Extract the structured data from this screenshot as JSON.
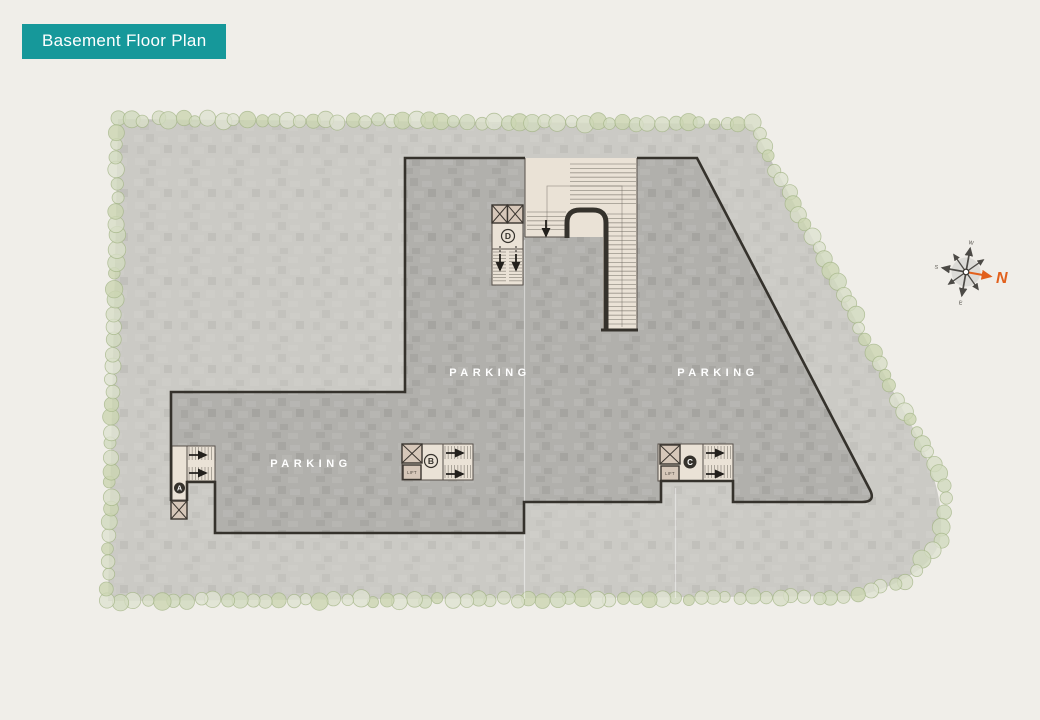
{
  "title": "Basement Floor Plan",
  "plan": {
    "parking_labels": [
      "PARKING",
      "PARKING",
      "PARKING"
    ],
    "cores": {
      "a": "A",
      "b": "B",
      "c": "C",
      "d": "D"
    },
    "lift_label": "LIFT"
  },
  "compass": {
    "north_label": "N",
    "west_label": "W",
    "south_label": "S",
    "east_label": "E"
  },
  "colors": {
    "banner": "#16989a",
    "bannerText": "#ffffff",
    "background": "#f0eee9",
    "site": "#cbcac5",
    "parking": "#b1b0ac",
    "outline": "#35322c",
    "core": "#eae2d6",
    "coreLine": "#57504a",
    "lift": "#d6c7b9",
    "tree": "#d9dfc8",
    "treeStroke": "#a6b789",
    "compassNorth": "#e2601c",
    "label": "#ffffff"
  }
}
